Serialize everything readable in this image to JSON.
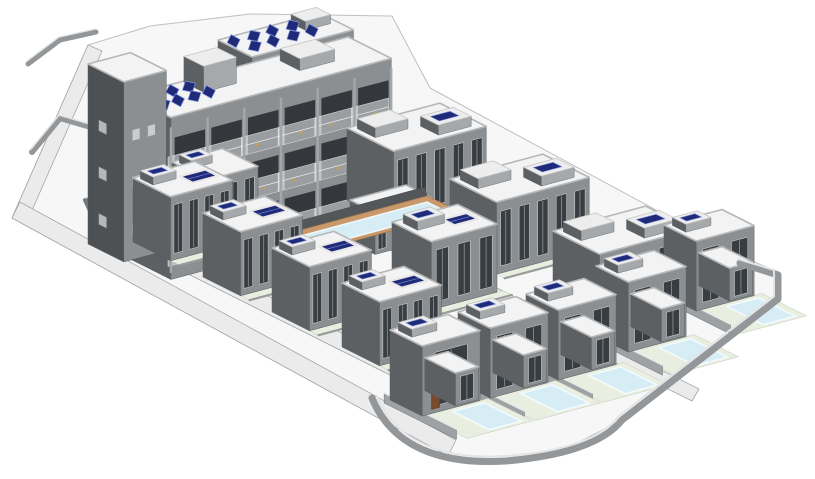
{
  "scene": {
    "canvas": {
      "width": 815,
      "height": 479
    },
    "palette": {
      "background": "#ffffff",
      "ground": "#f7f7f7",
      "ground_edge": "#c0c0c0",
      "road": "#ebebeb",
      "road_edge": "#a6a6a6",
      "wall_dark": "#5d6063",
      "wall_darker": "#4e5154",
      "wall_mid": "#8b8f91",
      "wall_light": "#a6a9ab",
      "pier": "#a4a7a9",
      "edge": "#5a5d60",
      "roof": "#f3f3f3",
      "roof_edge": "#b5b7b9",
      "bulk_roof": "#ededed",
      "window_dark": "#383d41",
      "window_frame": "#d8dadb",
      "window_light": "#c9cdd0",
      "window_sw": "#b4b8ba",
      "panel_navy": "#1f2a78",
      "panel_edge": "#8093dd",
      "pool_water": "#d6edf6",
      "pool_edge": "#f2fafc",
      "pool_deck": "#c9996b",
      "deck_edge": "#a87c4f",
      "path_green": "#e9efe0",
      "path_edge": "#c3c9b6",
      "fence_dark": "#53575a",
      "wall_stroke": "#94979a",
      "wall_top": "#e4e4e4",
      "door_brown": "#7a4a2c",
      "furniture": "#c8a050",
      "ac_dark": "#303438",
      "opening": "#34383c",
      "glass": "rgba(238,242,243,0.55)",
      "glass_line": "#e2e5e6"
    },
    "iso": {
      "A": [
        0.894,
        0.447
      ],
      "B": [
        0.966,
        -0.259
      ]
    },
    "ground_outline": "12,218 88,45 150,26 250,14 392,16 430,88 745,258 778,272 778,300 622,420 560,452 505,462 448,456",
    "roads": [
      {
        "id": "road-northwest",
        "points": "12,218 88,45 102,51 26,224"
      },
      {
        "id": "road-southwest",
        "points": "12,218 448,456 456,440 20,202"
      },
      {
        "id": "road-central",
        "points": "100,230 468,414 476,400 108,216"
      },
      {
        "id": "road-upper",
        "points": "338,224 692,401 699,389 345,212"
      }
    ],
    "walls": [
      {
        "id": "perimeter-wall",
        "d": "M 740,263 L 778,275 L 778,299 L 622,420 C 603,444 561,456 506,461 C 441,465 392,447 372,398",
        "w": 7
      },
      {
        "id": "topleft-wall",
        "d": "M 28,64 L 60,40 L 96,32",
        "w": 5
      },
      {
        "id": "terrace-wall",
        "d": "M 32,152 L 60,118 L 94,128",
        "w": 6
      }
    ],
    "planter": {
      "id": "planter-wall",
      "points": "85,200 112,193 118,206 91,213"
    },
    "pool": {
      "fence": "262,231 425,187 427,196 264,240",
      "deck": "264,240 427,196 461,212 298,256",
      "water": "282,241 427,202 447,212 302,251"
    },
    "buildings": [
      {
        "id": "apartment-rear-wing",
        "kind": "box",
        "x": 218,
        "y": 108,
        "w": 105,
        "d": 38,
        "h": 68,
        "win": 5,
        "panels": {
          "u0": 8,
          "v0": 6,
          "rows": 2,
          "cols": 4,
          "du": 20,
          "dv": 15
        },
        "bulks": [
          {
            "u": 72,
            "v": 4,
            "w": 26,
            "d": 16,
            "h": 9
          }
        ]
      },
      {
        "id": "apartment-main-wing",
        "kind": "apartment",
        "x": 128,
        "y": 258,
        "w": 228,
        "d": 48,
        "h": 162,
        "bays": 6,
        "panels": {
          "u0": 4,
          "v0": 8,
          "rows": 2,
          "cols": 4,
          "du": 16,
          "dv": 16
        },
        "bulks": [
          {
            "u": 56,
            "v": 2,
            "w": 34,
            "d": 22,
            "h": 26
          },
          {
            "u": 150,
            "v": 8,
            "w": 36,
            "d": 22,
            "h": 12
          }
        ]
      },
      {
        "id": "apartment-tower",
        "kind": "box",
        "x": 88,
        "y": 244,
        "w": 44,
        "d": 40,
        "h": 180,
        "swc": "#4e5154",
        "sewin": {
          "rows": 3,
          "cols": 2
        },
        "swin": {
          "rows": 3,
          "cols": 1
        }
      },
      {
        "id": "townhouse-pair-1",
        "kind": "town",
        "x": 347,
        "y": 200,
        "w": 96,
        "d": 52,
        "h": 72,
        "win": 5,
        "bulks": [
          {
            "u": 6,
            "v": 5,
            "w": 34,
            "d": 20,
            "h": 10
          },
          {
            "u": 52,
            "v": 26,
            "w": 34,
            "d": 20,
            "h": 10,
            "panel": true
          }
        ]
      },
      {
        "id": "townhouse-pair-2",
        "kind": "town",
        "x": 450,
        "y": 251,
        "w": 96,
        "d": 52,
        "h": 72,
        "win": 5,
        "bulks": [
          {
            "u": 6,
            "v": 5,
            "w": 34,
            "d": 20,
            "h": 10
          },
          {
            "u": 52,
            "v": 26,
            "w": 34,
            "d": 20,
            "h": 10,
            "panel": true
          }
        ]
      },
      {
        "id": "townhouse-pair-3",
        "kind": "town",
        "x": 553,
        "y": 303,
        "w": 96,
        "d": 52,
        "h": 72,
        "win": 5,
        "bulks": [
          {
            "u": 6,
            "v": 5,
            "w": 34,
            "d": 20,
            "h": 10
          },
          {
            "u": 52,
            "v": 26,
            "w": 34,
            "d": 20,
            "h": 10,
            "panel": true
          }
        ]
      },
      {
        "id": "courtyard-house-back",
        "kind": "mid",
        "x": 172,
        "y": 228,
        "w": 52,
        "d": 40,
        "h": 66,
        "win": 3,
        "bulks": [
          {
            "u": 4,
            "v": 4,
            "w": 22,
            "d": 13,
            "h": 8,
            "panel": true
          }
        ]
      },
      {
        "id": "pool-pavilion",
        "kind": "box",
        "x": 350,
        "y": 242,
        "w": 58,
        "d": 28,
        "h": 42,
        "win": 4
      },
      {
        "id": "communal-pool",
        "kind": "pool"
      },
      {
        "id": "courtyard-house-center",
        "kind": "mid",
        "x": 392,
        "y": 290,
        "w": 68,
        "d": 44,
        "h": 68,
        "win": 3,
        "bulks": [
          {
            "u": 6,
            "v": 6,
            "w": 28,
            "d": 16,
            "h": 9,
            "panel": true
          }
        ],
        "flatPanel": {
          "u": 38,
          "v": 16,
          "w": 24,
          "d": 13
        }
      },
      {
        "id": "courtyard-house-1",
        "kind": "mid",
        "x": 133,
        "y": 242,
        "w": 64,
        "d": 42,
        "h": 64,
        "win": 4,
        "bulks": [
          {
            "u": 4,
            "v": 4,
            "w": 24,
            "d": 14,
            "h": 8,
            "panel": true
          }
        ],
        "flatPanel": {
          "u": 34,
          "v": 16,
          "w": 26,
          "d": 14
        }
      },
      {
        "id": "courtyard-house-2",
        "kind": "mid",
        "x": 203,
        "y": 277,
        "w": 64,
        "d": 42,
        "h": 64,
        "win": 4,
        "bulks": [
          {
            "u": 4,
            "v": 4,
            "w": 24,
            "d": 14,
            "h": 8,
            "panel": true
          }
        ],
        "flatPanel": {
          "u": 34,
          "v": 16,
          "w": 26,
          "d": 14
        }
      },
      {
        "id": "courtyard-house-3",
        "kind": "mid",
        "x": 272,
        "y": 312,
        "w": 64,
        "d": 42,
        "h": 64,
        "win": 4,
        "bulks": [
          {
            "u": 4,
            "v": 4,
            "w": 24,
            "d": 14,
            "h": 8,
            "panel": true
          }
        ],
        "flatPanel": {
          "u": 34,
          "v": 16,
          "w": 26,
          "d": 14
        }
      },
      {
        "id": "villa-back-right",
        "kind": "villa",
        "x": 664,
        "y": 295,
        "w": 60,
        "d": 36,
        "h": 70,
        "win": 2,
        "yd": 50,
        "bulks": [
          {
            "u": 5,
            "v": 4,
            "w": 26,
            "d": 15,
            "h": 8,
            "panel": true
          }
        ]
      },
      {
        "id": "villa-back-left",
        "kind": "villa",
        "x": 596,
        "y": 336,
        "w": 60,
        "d": 36,
        "h": 70,
        "win": 2,
        "yd": 50,
        "bulks": [
          {
            "u": 5,
            "v": 4,
            "w": 26,
            "d": 15,
            "h": 8,
            "panel": true
          }
        ]
      },
      {
        "id": "courtyard-house-4",
        "kind": "mid",
        "x": 342,
        "y": 347,
        "w": 64,
        "d": 42,
        "h": 64,
        "win": 4,
        "bulks": [
          {
            "u": 4,
            "v": 4,
            "w": 24,
            "d": 14,
            "h": 8,
            "panel": true
          }
        ],
        "flatPanel": {
          "u": 34,
          "v": 16,
          "w": 26,
          "d": 14
        }
      },
      {
        "id": "villa-front-3",
        "kind": "villa",
        "x": 526,
        "y": 364,
        "w": 60,
        "d": 36,
        "h": 70,
        "win": 2,
        "yd": 50,
        "bulks": [
          {
            "u": 5,
            "v": 4,
            "w": 26,
            "d": 15,
            "h": 8,
            "panel": true
          }
        ]
      },
      {
        "id": "villa-front-2",
        "kind": "villa",
        "x": 458,
        "y": 382,
        "w": 60,
        "d": 36,
        "h": 70,
        "win": 2,
        "yd": 50,
        "bulks": [
          {
            "u": 5,
            "v": 4,
            "w": 26,
            "d": 15,
            "h": 8,
            "panel": true
          }
        ]
      },
      {
        "id": "villa-front-1",
        "kind": "villa",
        "x": 390,
        "y": 400,
        "w": 60,
        "d": 36,
        "h": 70,
        "win": 1,
        "yd": 50,
        "door": true,
        "bulks": [
          {
            "u": 5,
            "v": 4,
            "w": 26,
            "d": 15,
            "h": 8,
            "panel": true
          }
        ]
      }
    ]
  }
}
